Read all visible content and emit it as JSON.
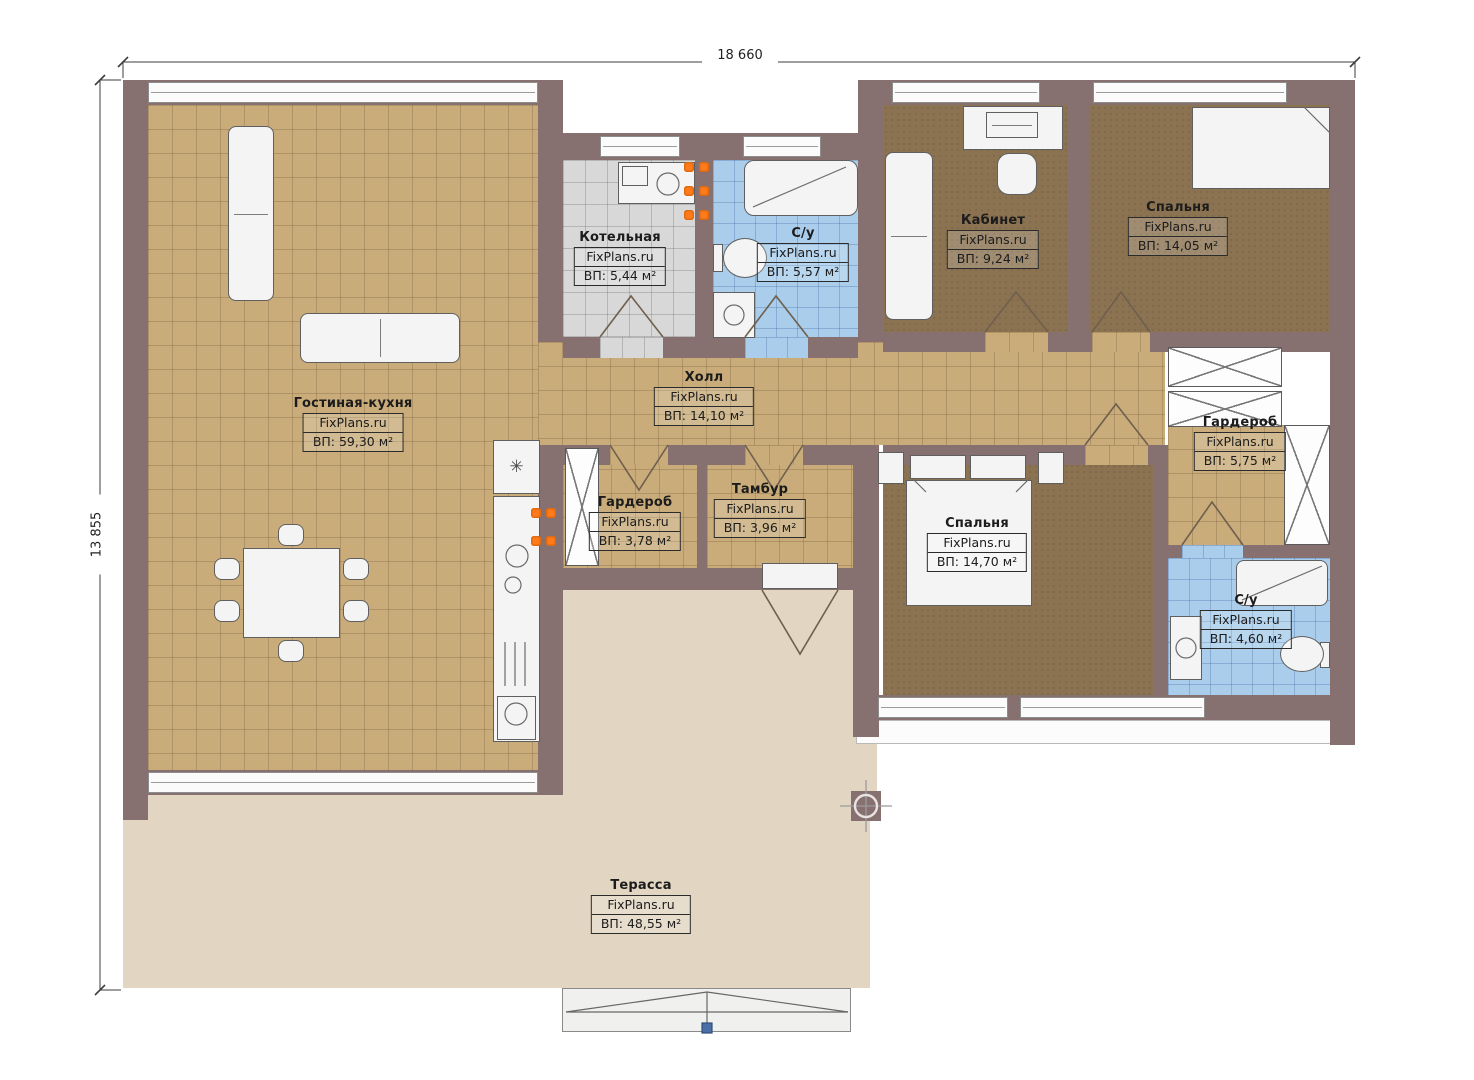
{
  "watermark": "FixPlans.ru",
  "dimensions": {
    "width_label": "18 660",
    "height_label": "13 855"
  },
  "icons": {
    "snowflake": "✳"
  },
  "rooms": [
    {
      "id": "living",
      "name": "Гостиная-кухня",
      "area": "ВП: 59,30 м²"
    },
    {
      "id": "boiler",
      "name": "Котельная",
      "area": "ВП: 5,44 м²"
    },
    {
      "id": "bath1",
      "name": "С/у",
      "area": "ВП: 5,57 м²"
    },
    {
      "id": "office",
      "name": "Кабинет",
      "area": "ВП: 9,24 м²"
    },
    {
      "id": "bedroom1",
      "name": "Спальня",
      "area": "ВП: 14,05 м²"
    },
    {
      "id": "hall",
      "name": "Холл",
      "area": "ВП: 14,10 м²"
    },
    {
      "id": "wardrobe1",
      "name": "Гардероб",
      "area": "ВП: 5,75 м²"
    },
    {
      "id": "wardrobe2",
      "name": "Гардероб",
      "area": "ВП: 3,78 м²"
    },
    {
      "id": "tambur",
      "name": "Тамбур",
      "area": "ВП: 3,96 м²"
    },
    {
      "id": "bedroom2",
      "name": "Спальня",
      "area": "ВП: 14,70 м²"
    },
    {
      "id": "bath2",
      "name": "С/у",
      "area": "ВП: 4,60 м²"
    },
    {
      "id": "terrace",
      "name": "Терасса",
      "area": "ВП: 48,55 м²"
    }
  ],
  "palette": {
    "wall": "#867170",
    "floor_tile": "#c9ac7a",
    "floor_carpet": "#8b7351",
    "floor_bath": "#aacdec",
    "floor_boiler": "#d8d8d8",
    "terrace": "#e2d6c3",
    "furniture": "#f4f4f4",
    "accent_burner": "#ff7a1a",
    "marker_blue": "#4a6fa5"
  }
}
